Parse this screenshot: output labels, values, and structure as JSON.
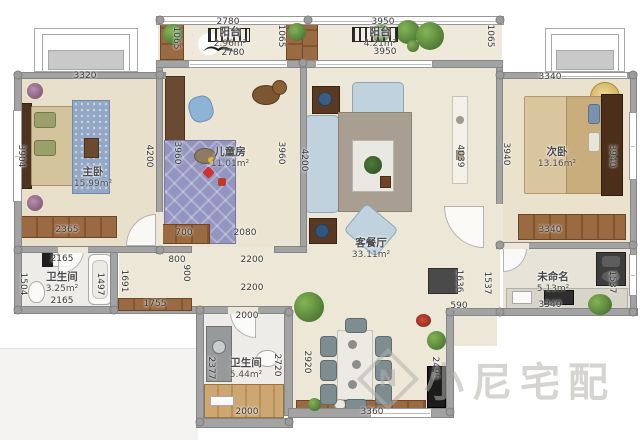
{
  "watermark": {
    "brand": "小尼宅配",
    "logo": "N"
  },
  "rooms": {
    "master": {
      "name": "主卧",
      "area": "15.99m²"
    },
    "kids": {
      "name": "儿童房",
      "area": "11.01m²"
    },
    "living": {
      "name": "客餐厅",
      "area": "33.11m²"
    },
    "second": {
      "name": "次卧",
      "area": "13.16m²"
    },
    "kitchen": {
      "name": "未命名",
      "area": "5.13m²"
    },
    "bath1": {
      "name": "卫生间",
      "area": "3.25m²"
    },
    "bath2": {
      "name": "卫生间",
      "area": "5.44m²"
    },
    "balcony1": {
      "name": "阳台",
      "area": "2.96m²"
    },
    "balcony2": {
      "name": "阳台",
      "area": "4.21m²"
    }
  },
  "dims": {
    "balcony1_top": "2780",
    "balcony1_bottom": "2780",
    "balcony1_col_left": "1065",
    "balcony1_col_right": "1065",
    "balcony2_top": "3950",
    "balcony2_bottom": "3950",
    "balcony2_col_right": "1065",
    "master_top": "3320",
    "master_left": "3904",
    "master_right": "4200",
    "master_wardrobe": "2365",
    "kids_left": "3960",
    "kids_right": "3960",
    "kids_cabinet": "700",
    "kids_bottom": "2080",
    "living_left": "4200",
    "living_right": "4039",
    "second_top": "3340",
    "second_left": "3940",
    "second_right": "3940",
    "second_wardrobe": "3340",
    "bath1_top": "2165",
    "bath1_bottom": "2165",
    "bath1_left": "1504",
    "bath1_right": "1497",
    "hall_width": "1691",
    "hall_800": "800",
    "hall_900": "900",
    "hall_2200a": "2200",
    "hall_2200b": "2200",
    "hall_cabinet": "1755",
    "hall_2000": "2000",
    "bath2_left": "2377",
    "bath2_right": "2720",
    "bath2_bottom": "2000",
    "dining_left": "2920",
    "dining_bottom": "3360",
    "entry_wall": "590",
    "entry_height": "2495",
    "entry_door": "1636",
    "kitchen_left": "1537",
    "kitchen_right": "1537",
    "kitchen_counter": "3340"
  }
}
